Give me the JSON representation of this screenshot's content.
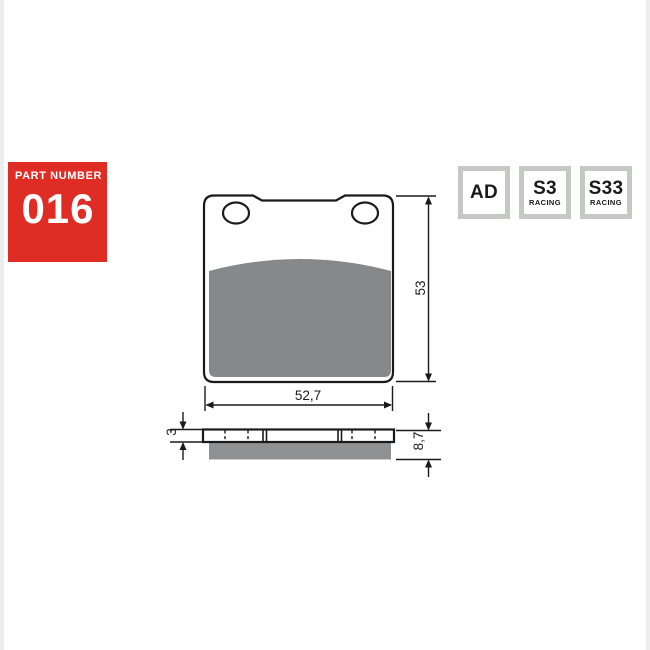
{
  "part_badge": {
    "label": "PART NUMBER",
    "number": "016",
    "bg_color": "#df2d26",
    "text_color": "#ffffff"
  },
  "compound_badges": [
    {
      "code": "AD",
      "sub": ""
    },
    {
      "code": "S3",
      "sub": "RACING"
    },
    {
      "code": "S33",
      "sub": "RACING"
    }
  ],
  "drawing": {
    "front_view": {
      "width_dim": "52,7",
      "height_dim": "53"
    },
    "side_view": {
      "plate_thickness_dim": "3",
      "total_thickness_dim": "8,7"
    },
    "colors": {
      "friction_front": "#868889",
      "friction_side": "#8f9192",
      "line": "#1a1a1a",
      "badge_border": "#c6c8c6",
      "part_badge_red": "#df2d26"
    }
  }
}
